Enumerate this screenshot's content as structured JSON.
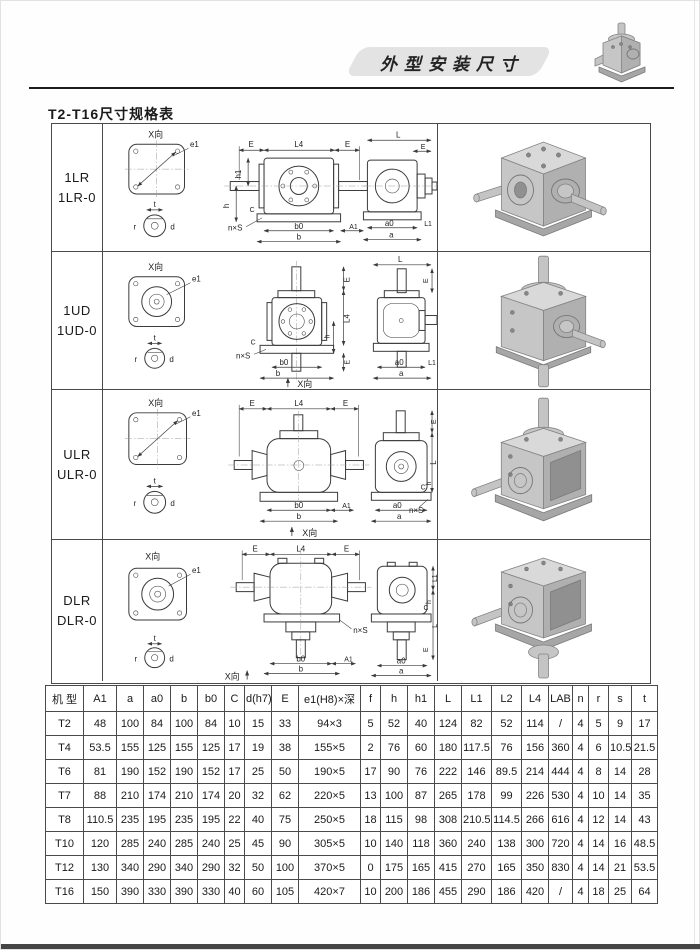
{
  "page": {
    "banner_title": "外型安装尺寸",
    "section_title": "T2-T16尺寸规格表"
  },
  "dims": {
    "x_view": "X向",
    "e1": "e1",
    "E": "E",
    "L4": "L4",
    "h1": "h1",
    "h": "h",
    "C": "C",
    "nxs": "n×S",
    "b0": "b0",
    "b": "b",
    "A1": "A1",
    "L": "L",
    "L1": "L1",
    "a0": "a0",
    "a": "a",
    "t": "t",
    "r": "r",
    "d": "d"
  },
  "main_table": {
    "rows": [
      {
        "model": [
          "1LR",
          "1LR-0"
        ]
      },
      {
        "model": [
          "1UD",
          "1UD-0"
        ]
      },
      {
        "model": [
          "ULR",
          "ULR-0"
        ]
      },
      {
        "model": [
          "DLR",
          "DLR-0"
        ]
      }
    ]
  },
  "spec_table": {
    "headers": [
      "机 型",
      "A1",
      "a",
      "a0",
      "b",
      "b0",
      "C",
      "d(h7)",
      "E",
      "e1(H8)×深",
      "f",
      "h",
      "h1",
      "L",
      "L1",
      "L2",
      "L4",
      "LAB",
      "n",
      "r",
      "s",
      "t"
    ],
    "rows": [
      [
        "T2",
        "48",
        "100",
        "84",
        "100",
        "84",
        "10",
        "15",
        "33",
        "94×3",
        "5",
        "52",
        "40",
        "124",
        "82",
        "52",
        "114",
        "/",
        "4",
        "5",
        "9",
        "17"
      ],
      [
        "T4",
        "53.5",
        "155",
        "125",
        "155",
        "125",
        "17",
        "19",
        "38",
        "155×5",
        "2",
        "76",
        "60",
        "180",
        "117.5",
        "76",
        "156",
        "360",
        "4",
        "6",
        "10.5",
        "21.5"
      ],
      [
        "T6",
        "81",
        "190",
        "152",
        "190",
        "152",
        "17",
        "25",
        "50",
        "190×5",
        "17",
        "90",
        "76",
        "222",
        "146",
        "89.5",
        "214",
        "444",
        "4",
        "8",
        "14",
        "28"
      ],
      [
        "T7",
        "88",
        "210",
        "174",
        "210",
        "174",
        "20",
        "32",
        "62",
        "220×5",
        "13",
        "100",
        "87",
        "265",
        "178",
        "99",
        "226",
        "530",
        "4",
        "10",
        "14",
        "35"
      ],
      [
        "T8",
        "110.5",
        "235",
        "195",
        "235",
        "195",
        "22",
        "40",
        "75",
        "250×5",
        "18",
        "115",
        "98",
        "308",
        "210.5",
        "114.5",
        "266",
        "616",
        "4",
        "12",
        "14",
        "43"
      ],
      [
        "T10",
        "120",
        "285",
        "240",
        "285",
        "240",
        "25",
        "45",
        "90",
        "305×5",
        "10",
        "140",
        "118",
        "360",
        "240",
        "138",
        "300",
        "720",
        "4",
        "14",
        "16",
        "48.5"
      ],
      [
        "T12",
        "130",
        "340",
        "290",
        "340",
        "290",
        "32",
        "50",
        "100",
        "370×5",
        "0",
        "175",
        "165",
        "415",
        "270",
        "165",
        "350",
        "830",
        "4",
        "14",
        "21",
        "53.5"
      ],
      [
        "T16",
        "150",
        "390",
        "330",
        "390",
        "330",
        "40",
        "60",
        "105",
        "420×7",
        "10",
        "200",
        "186",
        "455",
        "290",
        "186",
        "420",
        "/",
        "4",
        "18",
        "25",
        "64"
      ]
    ]
  }
}
